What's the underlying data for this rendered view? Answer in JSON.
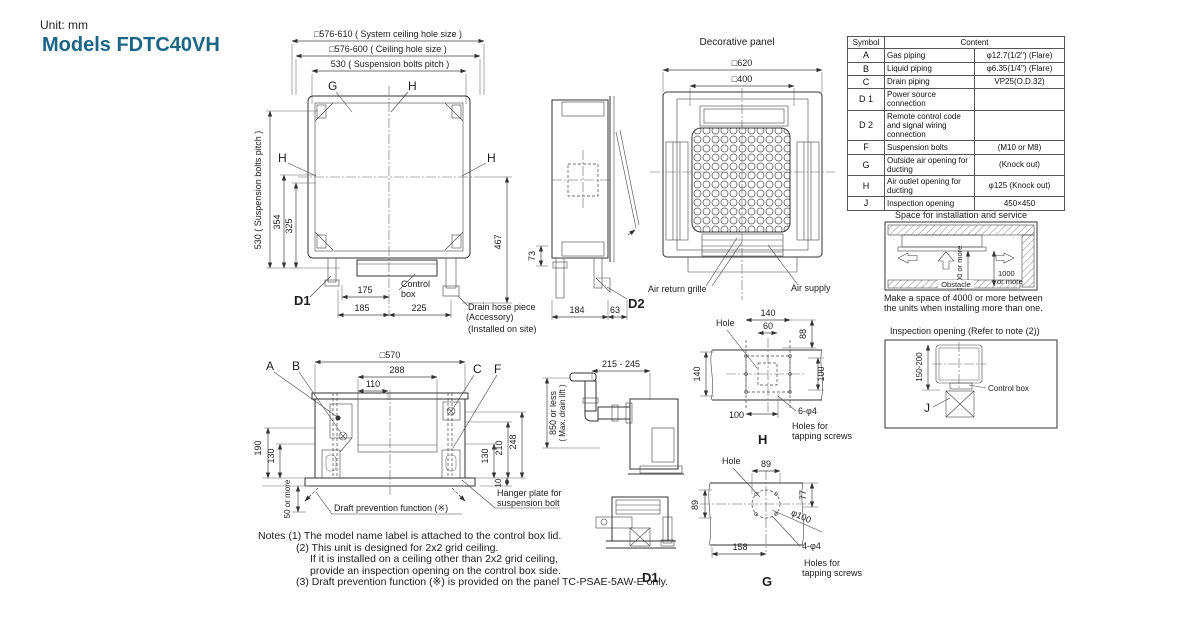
{
  "header": {
    "unit": "Unit: mm",
    "model": "Models FDTC40VH",
    "accent_color": "#1b6584"
  },
  "top_view": {
    "dim_sys_ceiling": "□576-610 ( System ceiling hole size )",
    "dim_ceiling": "□576-600 ( Ceiling hole size )",
    "dim_pitch": "530   ( Suspension bolts pitch )",
    "dim_pitch_v": "530 ( Suspension bolts pitch )",
    "dim_354": "354",
    "dim_325": "325",
    "g": "G",
    "h": "H",
    "h_left": "H",
    "h_right": "H",
    "d1": "D1",
    "dim_175": "175",
    "dim_185": "185",
    "dim_225": "225",
    "control_box_1": "Control",
    "control_box_2": "box",
    "dim_467": "467",
    "dim_73": "73",
    "drain_1": "Drain hose piece",
    "drain_2": "(Accessory)",
    "drain_3": "(Installed on site)"
  },
  "side_view": {
    "d2": "D2",
    "dim_184": "184",
    "dim_63": "63"
  },
  "panel_view": {
    "title": "Decorative panel",
    "dim_620": "□620",
    "dim_400": "□400",
    "air_return": "Air return grille",
    "air_supply": "Air supply"
  },
  "symbol_table": {
    "header_symbol": "Symbol",
    "header_content": "Content",
    "rows": [
      {
        "symbol": "A",
        "desc": "Gas piping",
        "value": "φ12.7(1/2\") (Flare)"
      },
      {
        "symbol": "B",
        "desc": "Liquid piping",
        "value": "φ6.35(1/4\") (Flare)"
      },
      {
        "symbol": "C",
        "desc": "Drain piping",
        "value": "VP25(O.D.32)"
      },
      {
        "symbol": "D 1",
        "desc": "Power source connection",
        "value": ""
      },
      {
        "symbol": "D 2",
        "desc": "Remote control code and signal wiring connection",
        "value": ""
      },
      {
        "symbol": "F",
        "desc": "Suspension bolts",
        "value": "(M10 or M8)"
      },
      {
        "symbol": "G",
        "desc": "Outside air opening for ducting",
        "value": "(Knock out)"
      },
      {
        "symbol": "H",
        "desc": "Air outlet opening for ducting",
        "value": "φ125 (Knock out)"
      },
      {
        "symbol": "J",
        "desc": "Inspection opening",
        "value": "450×450"
      }
    ]
  },
  "space": {
    "title": "Space for installation and service",
    "dim_v": "1000 or more",
    "dim_r1": "1000",
    "dim_r2": "or more",
    "obstacle": "Obstacle",
    "cap1": "Make a space of 4000 or more between",
    "cap2": "the units when installing more than one."
  },
  "inspection": {
    "title": "Inspection opening (Refer to note (2))",
    "dim": "150-200",
    "control_box": "Control box",
    "j": "J"
  },
  "bottom_view": {
    "dim_570": "□570",
    "dim_288": "288",
    "dim_110": "110",
    "a": "A",
    "b": "B",
    "c": "C",
    "f": "F",
    "dim_190": "190",
    "dim_130l": "130",
    "dim_130r": "130",
    "dim_210": "210",
    "dim_248": "248",
    "dim_50": "50 or more",
    "dim_10": "10",
    "draft": "Draft prevention function (※)",
    "hanger_1": "Hanger plate for",
    "hanger_2": "suspension bolt"
  },
  "drain_view": {
    "dim_range": "215 - 245",
    "dim_850": "850 or less",
    "dim_850b": "( Max. drain lift )"
  },
  "h_view": {
    "hole": "Hole",
    "d140t": "140",
    "d60": "60",
    "d88": "88",
    "d140l": "140",
    "d100r": "100",
    "d100b": "100",
    "screws": "6-φ4",
    "holes1": "Holes for",
    "holes2": "tapping screws",
    "label": "H"
  },
  "g_view": {
    "hole": "Hole",
    "d89t": "89",
    "d77": "77",
    "d89l": "89",
    "d100": "φ100",
    "d158": "158",
    "screws": "4-φ4",
    "holes1": "Holes for",
    "holes2": "tapping screws",
    "label": "G"
  },
  "d1_view": {
    "label": "D1"
  },
  "notes": {
    "label": "Notes",
    "line1": "(1) The model name label is attached to the control box lid.",
    "line2": "(2) This unit is designed for 2x2 grid ceiling.",
    "line3": "If it is installed on a ceiling other than 2x2 grid ceiling,",
    "line4": "provide an inspection opening on the control box side.",
    "line5": "(3) Draft prevention function (※) is provided on the panel TC-PSAE-5AW-E only."
  }
}
